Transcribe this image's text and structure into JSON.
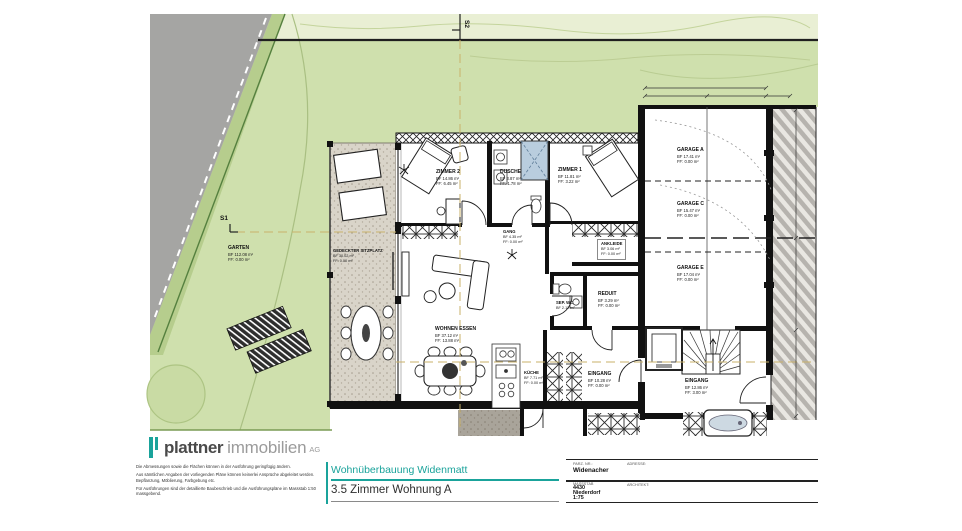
{
  "meta": {
    "project": "Wohnüberbauung Widenmatt",
    "plan_title": "3.5 Zimmer Wohnung A"
  },
  "logo": {
    "name": "plattner",
    "mid": "immobilien",
    "ag": "AG"
  },
  "disclaimer": {
    "p1": "Die Abmessungen sowie die Flächen können in der Ausführung geringfügig ändern.",
    "p2": "Aus sämtlichen Angaben der vorliegenden Pläne können keinerlei Ansprüche abgeleitet werden. Bepflanzung, Möblierung, Farbgebung etc.",
    "p3": "Für Ausführungen sind der detaillierte Baubeschrieb und die Ausführungspläne im Massstab 1:50 massgebend."
  },
  "titleblock": {
    "parz_label": "PARZ. NR.:",
    "adresse_label": "ADRESSE:",
    "massstab_label": "MASSSTAB",
    "architekt_label": "ARCHITEKT:",
    "street": "Widenacher",
    "plz": "4430",
    "ort": "Niederdorf",
    "scale": "1:75"
  },
  "sections": {
    "s1": "S1",
    "s2": "S2"
  },
  "rooms": {
    "garten": {
      "name": "GARTEN",
      "bf": "BF 112.08 m²",
      "ff": "FF: 0.00 m²"
    },
    "sitzplatz": {
      "name": "GEDECKTER SITZPLATZ",
      "bf": "BF 30.02 m²",
      "ff": "FF: 0.00 m²"
    },
    "zimmer2": {
      "name": "ZIMMER 2",
      "bf": "BF 14.86 m²",
      "ff": "FF: 6.45 m²"
    },
    "dusche": {
      "name": "DUSCHE",
      "bf": "BF 3.87 m²",
      "ff": "FF: 1.78 m²"
    },
    "zimmer1": {
      "name": "ZIMMER 1",
      "bf": "BF 11.81 m²",
      "ff": "FF: 3.22 m²"
    },
    "gang": {
      "name": "GANG",
      "bf": "BF 4.35 m²",
      "ff": "FF: 0.00 m²"
    },
    "ankleide": {
      "name": "ANKLEIDE",
      "bf": "BF 3.06 m²",
      "ff": "FF: 0.00 m²"
    },
    "sep_wc": {
      "name": "SEP. WC",
      "bf": "BF 2.12 m²",
      "ff": "FF: 0.00 m²"
    },
    "reduit": {
      "name": "REDUIT",
      "bf": "BF 3.29 m²",
      "ff": "FF: 0.00 m²"
    },
    "wohnen_essen": {
      "name": "WOHNEN ESSEN",
      "bf": "BF 37.12 m²",
      "ff": "FF: 13.88 m²"
    },
    "kueche": {
      "name": "KÜCHE",
      "bf": "BF 7.71 m²",
      "ff": "FF: 0.00 m²"
    },
    "eingang_whg": {
      "name": "EINGANG",
      "bf": "BF 10.28 m²",
      "ff": "FF: 0.00 m²"
    },
    "eingang_haus": {
      "name": "EINGANG",
      "bf": "BF 12.86 m²",
      "ff": "FF: 3.00 m²"
    },
    "garage_a": {
      "name": "GARAGE A",
      "bf": "BF 17.41 m²",
      "ff": "FF: 0.00 m²"
    },
    "garage_c": {
      "name": "GARAGE C",
      "bf": "BF 15.47 m²",
      "ff": "FF: 0.00 m²"
    },
    "garage_e": {
      "name": "GARAGE E",
      "bf": "BF 17.04 m²",
      "ff": "FF: 0.00 m²"
    }
  },
  "colors": {
    "accent_teal": "#1aa39b",
    "garden_green": "#cfe0ad",
    "road_gray": "#a5a5a3",
    "shower_blue": "#b9cdde",
    "wall_black": "#111111"
  }
}
